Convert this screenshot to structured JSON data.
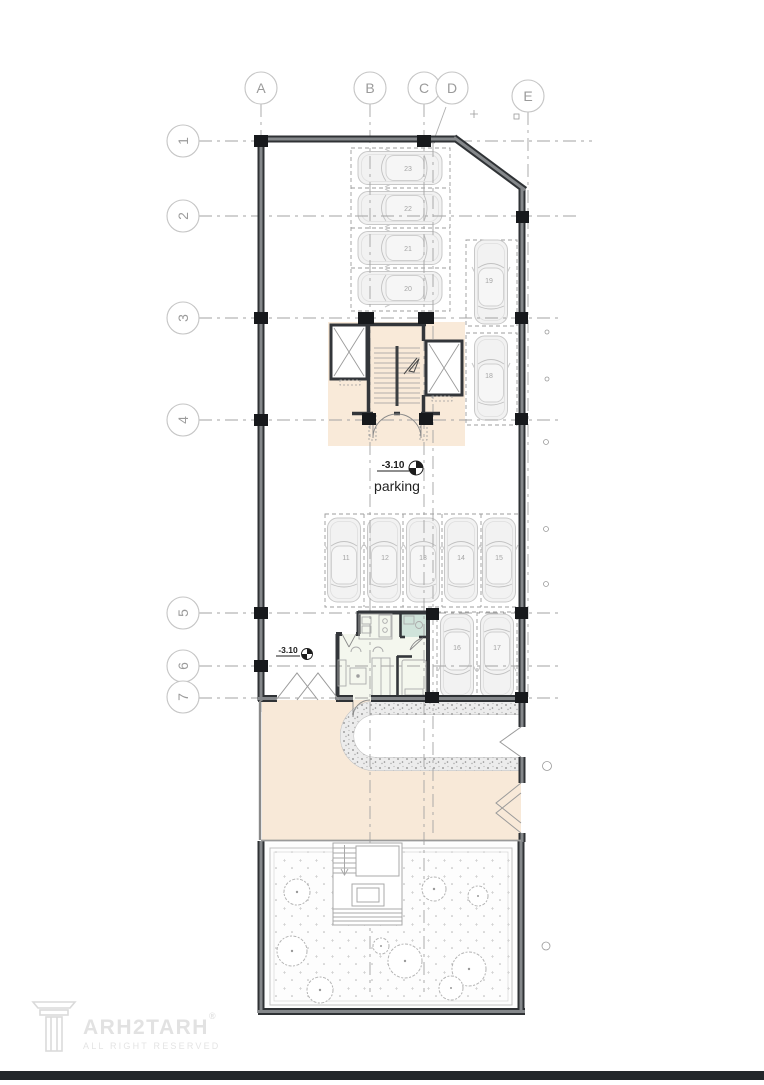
{
  "grid": {
    "columns": [
      {
        "label": "A"
      },
      {
        "label": "B"
      },
      {
        "label": "C"
      },
      {
        "label": "D"
      },
      {
        "label": "E"
      }
    ],
    "rows": [
      {
        "label": "1"
      },
      {
        "label": "2"
      },
      {
        "label": "3"
      },
      {
        "label": "4"
      },
      {
        "label": "5"
      },
      {
        "label": "6"
      },
      {
        "label": "7"
      }
    ]
  },
  "annotations": {
    "parking_level": "-3.10",
    "parking_label": "parking",
    "entrance_level": "-3.10"
  },
  "parking_stalls": {
    "top_block": [
      "23",
      "22",
      "21",
      "20"
    ],
    "right_upper": [
      "19",
      "18"
    ],
    "middle_row": [
      "11",
      "12",
      "13",
      "14",
      "15"
    ],
    "right_lower": [
      "16",
      "17"
    ]
  },
  "logo": {
    "brand": "ARH2TARH",
    "registered": "®",
    "tagline": "ALL RIGHT RESERVED"
  },
  "colors": {
    "wall_dark": "#2f3235",
    "wall_core": "#85888b",
    "column_black": "#17191c",
    "core_beige": "#f9ead9",
    "courtyard_beige": "#f8e9d8",
    "bath_green": "#cfe3da",
    "unit_fill": "#f4f7ee",
    "grid_gray": "#a3a3a3",
    "footer_bar": "#23272b"
  }
}
